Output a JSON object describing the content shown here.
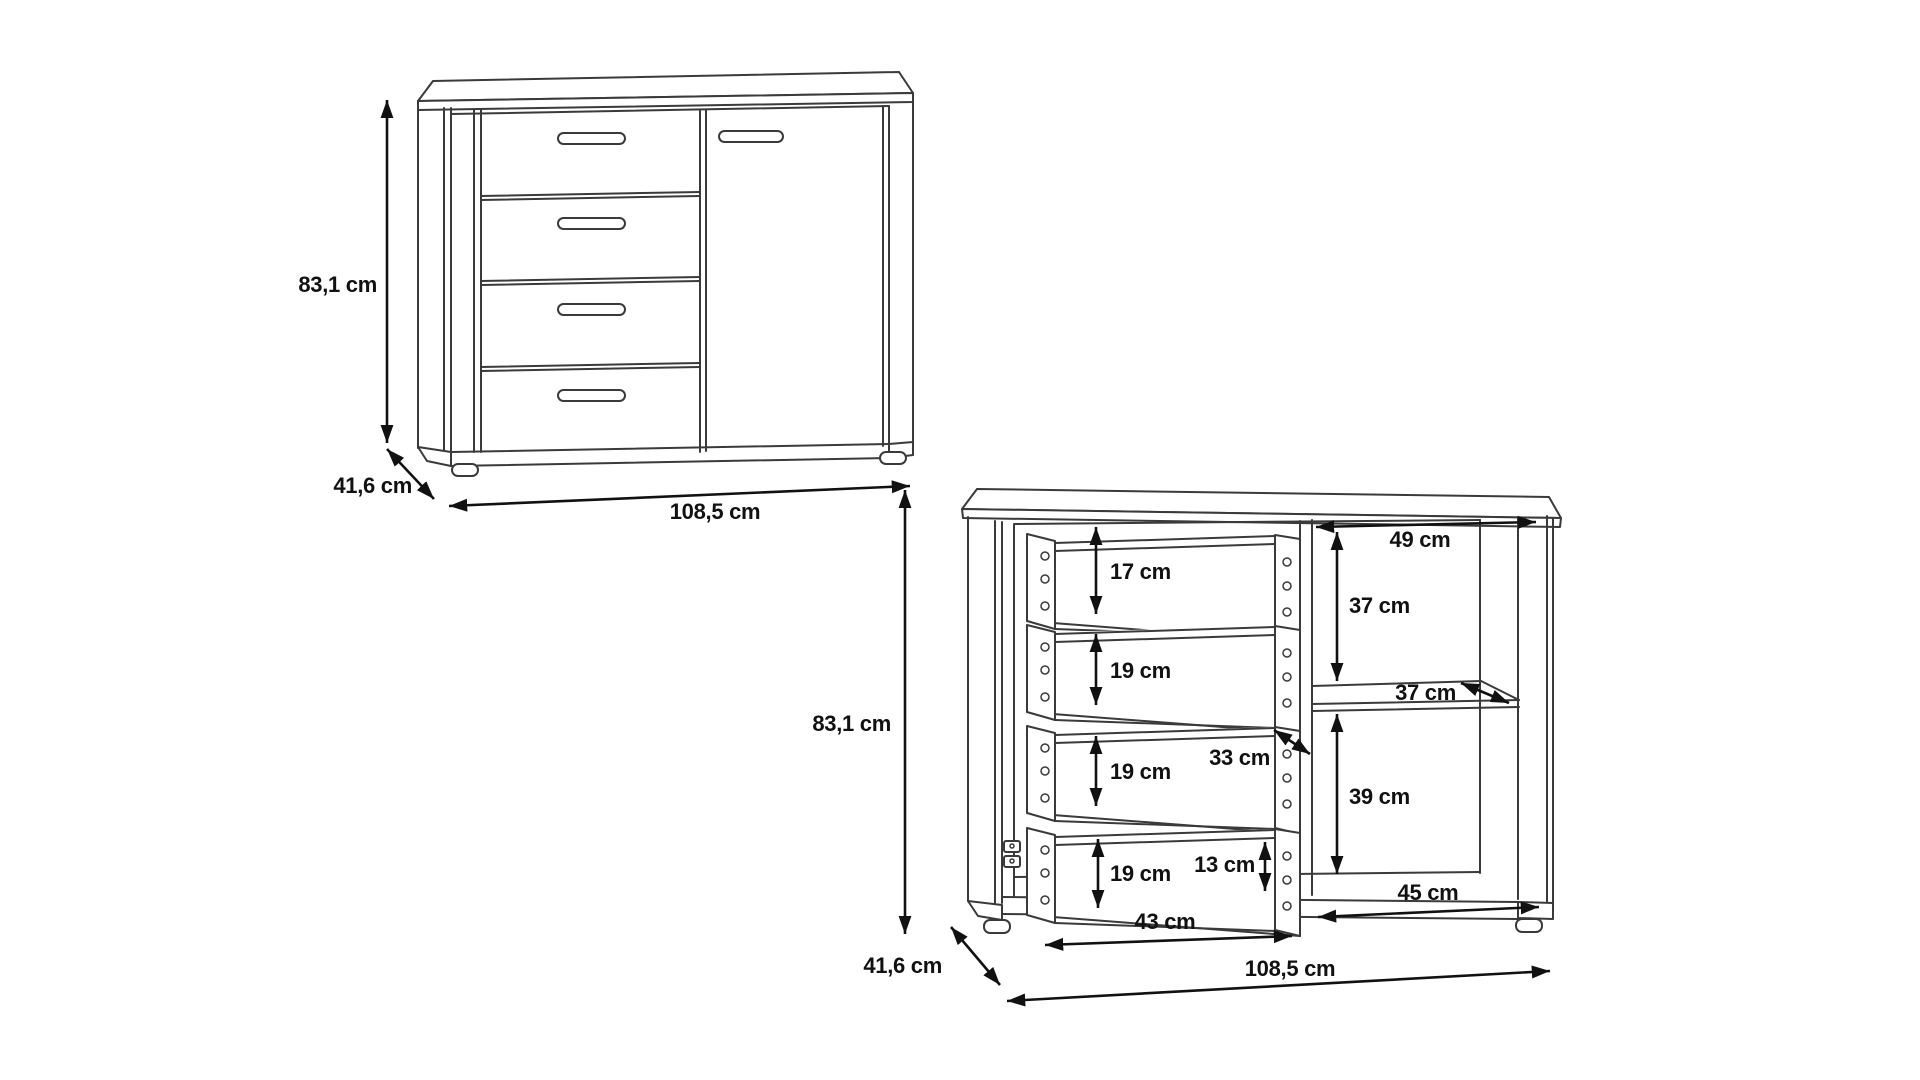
{
  "page": {
    "background": "#ffffff"
  },
  "colors": {
    "furniture_line": "#3a3a3a",
    "dimension_line": "#111111",
    "text": "#111111"
  },
  "closed_view": {
    "height": "83,1 cm",
    "depth": "41,6 cm",
    "width": "108,5 cm"
  },
  "open_view": {
    "height": "83,1 cm",
    "depth": "41,6 cm",
    "width": "108,5 cm",
    "drawer_heights": [
      "17 cm",
      "19 cm",
      "19 cm",
      "19 cm"
    ],
    "top_compartment_width": "49 cm",
    "upper_right_height": "37 cm",
    "shelf_depth": "37 cm",
    "drawer_depth": "33 cm",
    "lower_right_height": "39 cm",
    "bottom_drawer_front_height": "13 cm",
    "bottom_drawer_width": "43 cm",
    "bottom_compartment_width": "45 cm"
  }
}
